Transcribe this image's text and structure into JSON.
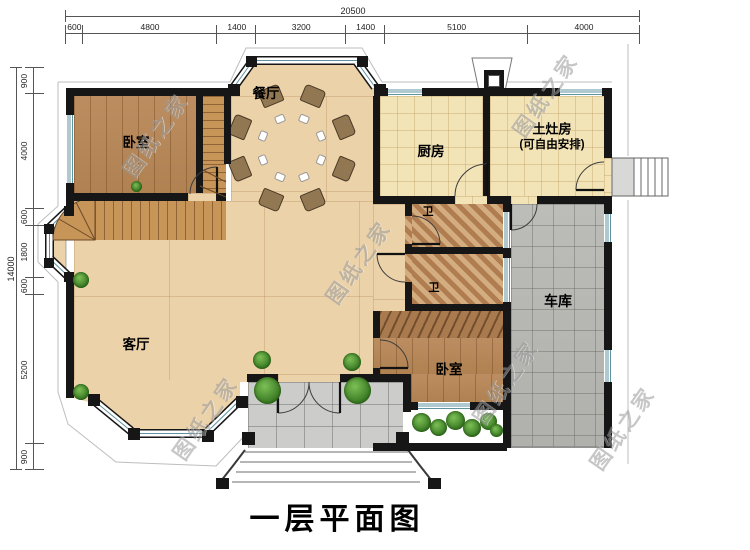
{
  "title": "一层平面图",
  "watermark_text": "图纸之家",
  "dimensions": {
    "top": {
      "total_label": "20500",
      "segments": [
        600,
        4800,
        1400,
        3200,
        1400,
        5100,
        4000
      ]
    },
    "left": {
      "total_label": "14000",
      "segments": [
        900,
        4000,
        600,
        1800,
        600,
        5200,
        900
      ]
    }
  },
  "rooms": {
    "bedroom1": "卧室",
    "dining": "餐厅",
    "kitchen": "厨房",
    "stove_room_line1": "土灶房",
    "stove_room_line2": "(可自由安排)",
    "bath_upper": "卫",
    "bath_lower": "卫",
    "living": "客厅",
    "garage": "车库",
    "bedroom2": "卧室"
  },
  "colors": {
    "wall": "#161616",
    "wood_floor": "#b5885c",
    "tile_floor": "#ecd2a8",
    "kitchen_floor": "#f3e4b8",
    "bath_floor": "#c59a6c",
    "garage_floor": "#b6b6b2",
    "porch_floor": "#cccccb",
    "window_glass": "#5f93a0",
    "dining_table": "#463528",
    "sofa": "#ead9ae"
  }
}
